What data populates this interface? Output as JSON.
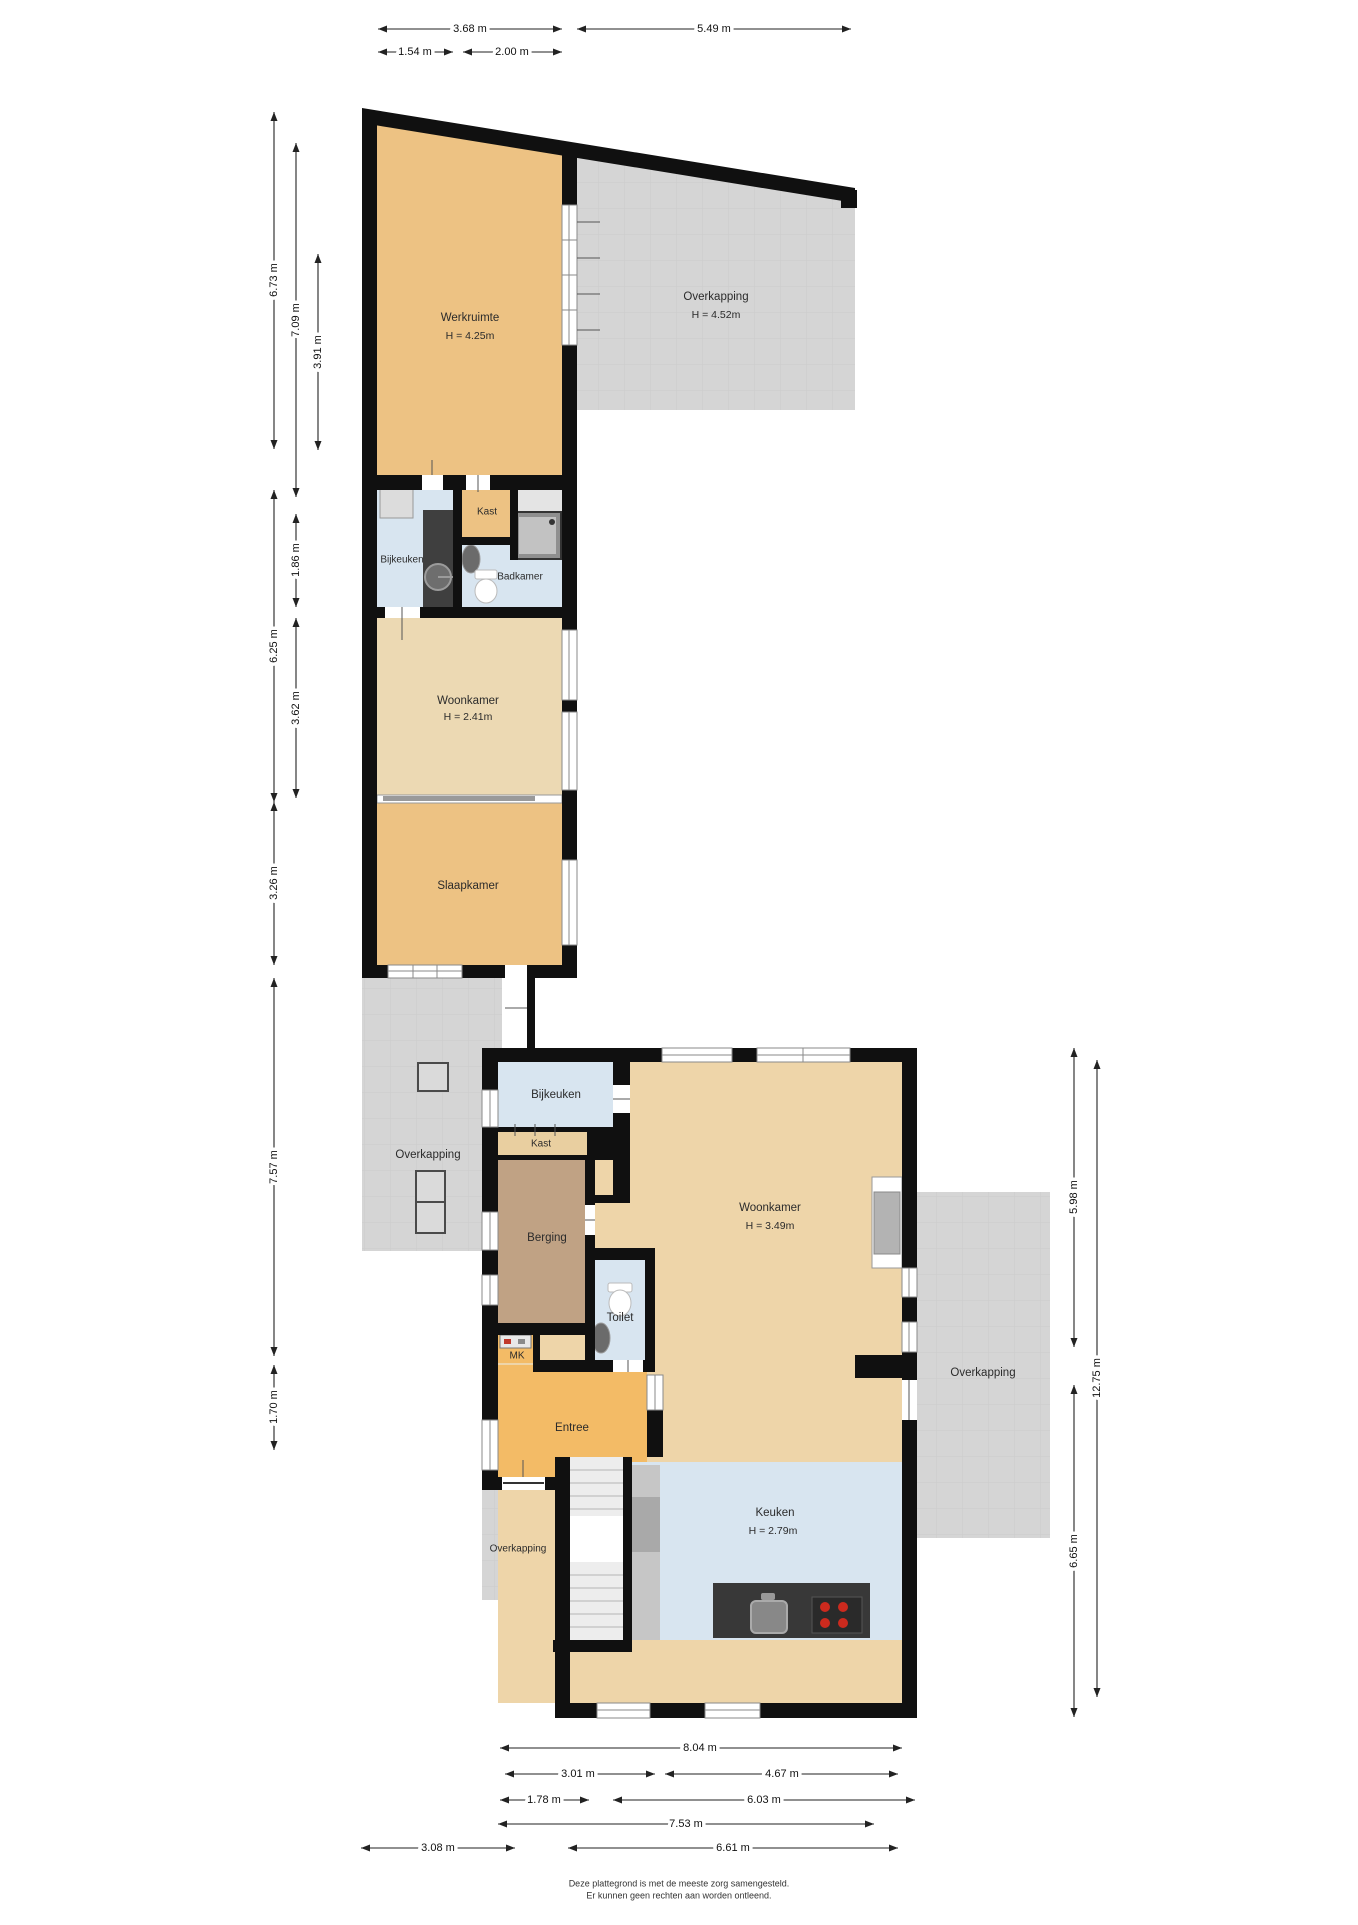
{
  "fp": {
    "rooms": {
      "werkruimte": {
        "label": "Werkruimte",
        "height": "H = 4.25m"
      },
      "overkapping_top": {
        "label": "Overkapping",
        "height": "H = 4.52m"
      },
      "bijkeuken_upper": {
        "label": "Bijkeuken"
      },
      "kast_upper": {
        "label": "Kast"
      },
      "badkamer": {
        "label": "Badkamer"
      },
      "woonkamer_upper": {
        "label": "Woonkamer",
        "height": "H = 2.41m"
      },
      "slaapkamer": {
        "label": "Slaapkamer"
      },
      "overkapping_mid": {
        "label": "Overkapping"
      },
      "bijkeuken": {
        "label": "Bijkeuken"
      },
      "kast": {
        "label": "Kast"
      },
      "berging": {
        "label": "Berging"
      },
      "woonkamer": {
        "label": "Woonkamer",
        "height": "H = 3.49m"
      },
      "toilet": {
        "label": "Toilet"
      },
      "mk": {
        "label": "MK"
      },
      "entree": {
        "label": "Entree"
      },
      "overkapping_right": {
        "label": "Overkapping"
      },
      "overkapping_entry": {
        "label": "Overkapping"
      },
      "keuken": {
        "label": "Keuken",
        "height": "H = 2.79m"
      }
    },
    "dimensions": {
      "top": [
        "3.68 m",
        "5.49 m",
        "1.54 m",
        "2.00 m"
      ],
      "left": [
        "6.73 m",
        "7.09 m",
        "3.91 m",
        "1.86 m",
        "6.25 m",
        "3.62 m",
        "3.26 m",
        "7.57 m",
        "1.70 m"
      ],
      "right": [
        "5.98 m",
        "12.75 m",
        "6.65 m"
      ],
      "bottom": [
        "8.04 m",
        "3.01 m",
        "4.67 m",
        "1.78 m",
        "6.03 m",
        "7.53 m",
        "3.08 m",
        "6.61 m"
      ]
    },
    "footer": {
      "line1": "Deze plattegrond is met de meeste zorg samengesteld.",
      "line2": "Er kunnen geen rechten aan worden ontleend."
    },
    "colors": {
      "wall": "#101010",
      "overkapping_fill": "#d5d5d5",
      "room_orange": "#edc283",
      "room_tan": "#eed5a9",
      "room_tan_light": "#ecd9b3",
      "room_blue": "#d8e5f0",
      "room_brown": "#c0a284",
      "entree_orange": "#f3bb66",
      "kast_tan": "#e9cfa0",
      "island_dark": "#383838",
      "burner_red": "#cc2a1e"
    }
  }
}
